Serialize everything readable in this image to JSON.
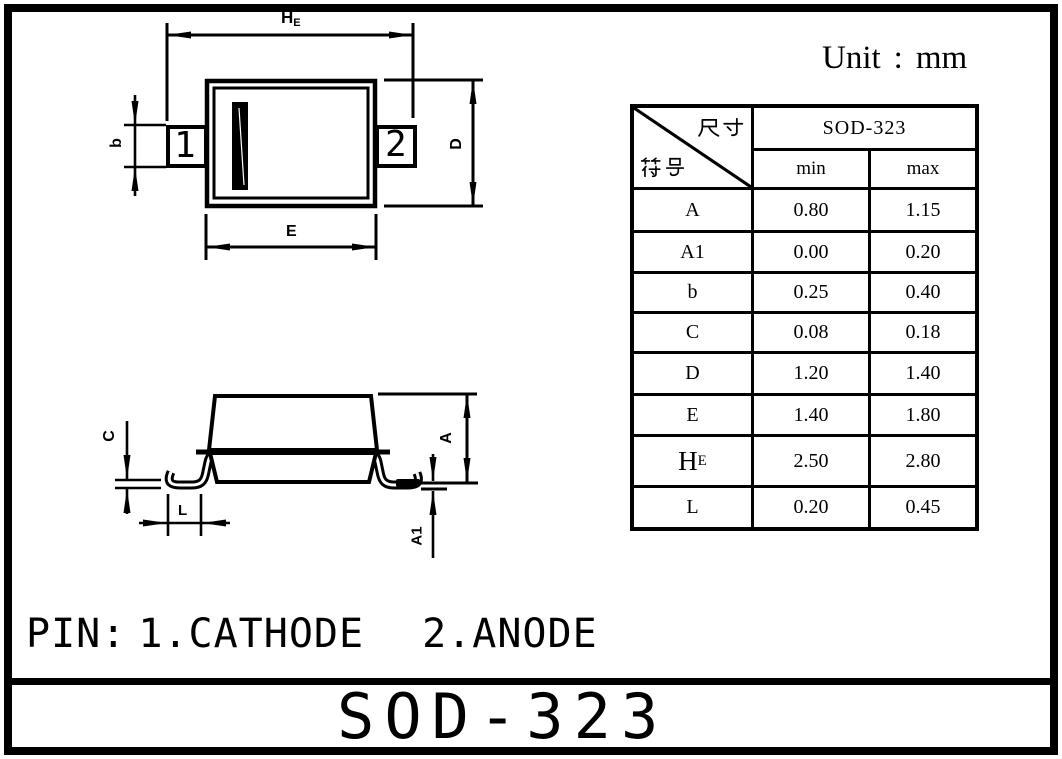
{
  "page": {
    "unit_label": "Unit",
    "unit_colon": "：",
    "unit_value": "mm",
    "title": "SOD-323",
    "pin_note": {
      "prefix": "PIN:",
      "item1": "1.CATHODE",
      "item2": "2.ANODE"
    }
  },
  "top_view": {
    "pin1": "1",
    "pin2": "2",
    "dims": {
      "he_main": "H",
      "he_sub": "E",
      "b": "b",
      "d": "D",
      "e": "E"
    }
  },
  "side_view": {
    "dims": {
      "c": "C",
      "l": "L",
      "a": "A",
      "a1": "A1"
    }
  },
  "table": {
    "corner": {
      "top_right": "尺寸",
      "bottom_left": "符号"
    },
    "package_header": "SOD-323",
    "col_min": "min",
    "col_max": "max",
    "rows": [
      {
        "symbol": "A",
        "sub": "",
        "min": "0.80",
        "max": "1.15"
      },
      {
        "symbol": "A1",
        "sub": "",
        "min": "0.00",
        "max": "0.20"
      },
      {
        "symbol": "b",
        "sub": "",
        "min": "0.25",
        "max": "0.40"
      },
      {
        "symbol": "C",
        "sub": "",
        "min": "0.08",
        "max": "0.18"
      },
      {
        "symbol": "D",
        "sub": "",
        "min": "1.20",
        "max": "1.40"
      },
      {
        "symbol": "E",
        "sub": "",
        "min": "1.40",
        "max": "1.80"
      },
      {
        "symbol": "H",
        "sub": "E",
        "min": "2.50",
        "max": "2.80"
      },
      {
        "symbol": "L",
        "sub": "",
        "min": "0.20",
        "max": "0.45"
      }
    ]
  }
}
